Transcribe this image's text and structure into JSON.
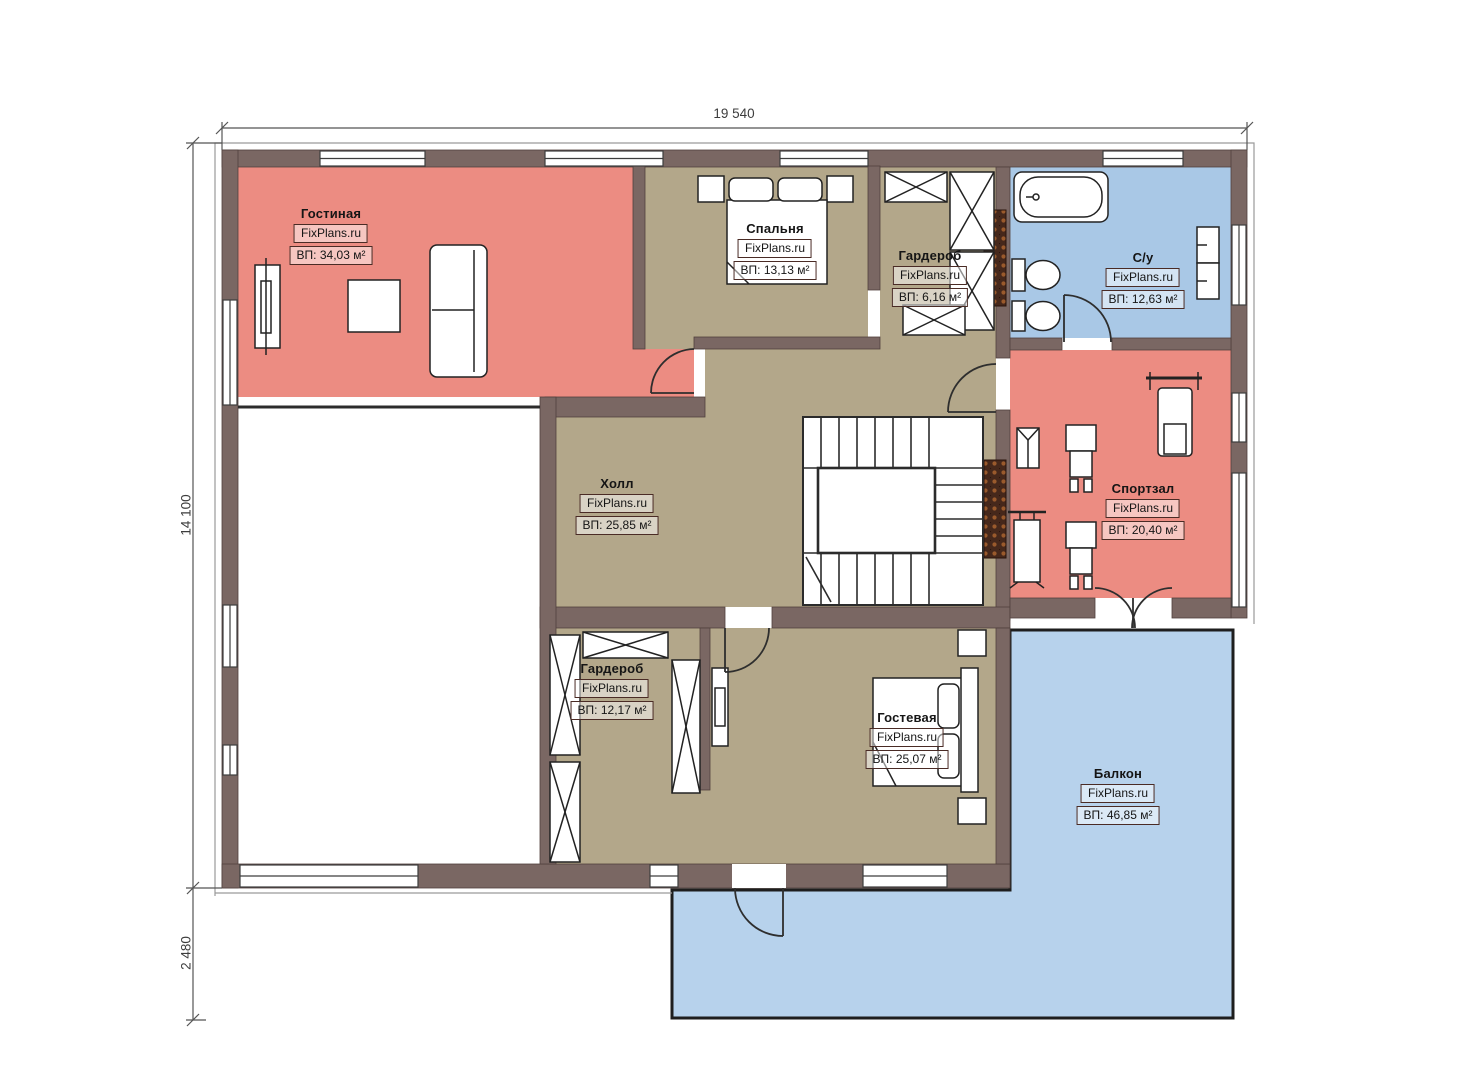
{
  "plan": {
    "title": "Floor plan level 2",
    "brand": "FixPlans.ru",
    "rooms": [
      {
        "name": "Гостиная",
        "area": "ВП: 34,03 м²"
      },
      {
        "name": "Спальня",
        "area": "ВП: 13,13 м²"
      },
      {
        "name": "Гардероб",
        "area": "ВП: 6,16 м²"
      },
      {
        "name": "С/у",
        "area": "ВП: 12,63 м²"
      },
      {
        "name": "Холл",
        "area": "ВП: 25,85 м²"
      },
      {
        "name": "Спортзал",
        "area": "ВП: 20,40 м²"
      },
      {
        "name": "Гардероб",
        "area": "ВП: 12,17 м²"
      },
      {
        "name": "Гостевая",
        "area": "ВП: 25,07 м²"
      },
      {
        "name": "Балкон",
        "area": "ВП: 46,85 м²"
      }
    ],
    "dimensions": {
      "top": "19 540",
      "left": "14 100",
      "left_lower": "2 480"
    },
    "colors": {
      "wall": "#7a6763",
      "room_pink": "#ec8c82",
      "room_beige": "#b3a78a",
      "bath_blue": "#a9c8e6",
      "balcony_blue": "#b7d2ec",
      "texture_brown": "#46281b"
    }
  }
}
